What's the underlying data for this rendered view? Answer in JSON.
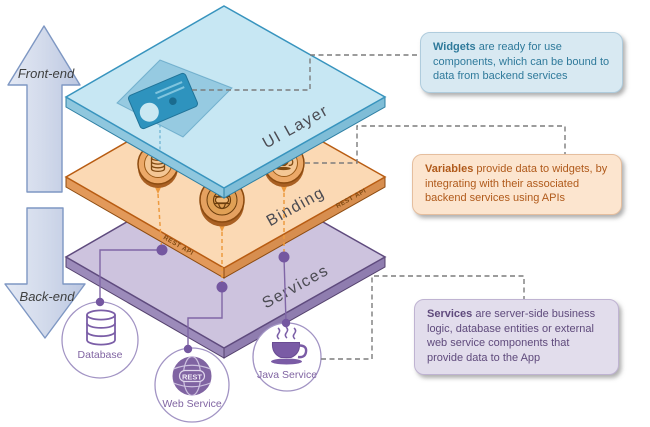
{
  "arrows": {
    "front_end_label": "Front-end",
    "back_end_label": "Back-end",
    "fill": "#D5DCEC",
    "border": "#7E97C3"
  },
  "layers": {
    "ui": {
      "label": "UI Layer",
      "fill": "#C7E7F3",
      "accent": "#3894BE",
      "widget_icon": "profile-card-icon"
    },
    "binding": {
      "label": "Binding",
      "edge_label": "REST API",
      "fill": "#FBD9B4",
      "accent": "#B85C12",
      "coin_icons": [
        "database-icon",
        "rest-globe-icon",
        "coffee-cup-icon"
      ]
    },
    "services": {
      "label": "Services",
      "fill": "#CDC3DE",
      "accent": "#5F4B7E"
    }
  },
  "backend_services": [
    {
      "label": "Database",
      "icon": "database-cylinder-icon"
    },
    {
      "label": "Web Service",
      "icon": "rest-globe-icon",
      "badge": "REST"
    },
    {
      "label": "Java Service",
      "icon": "coffee-cup-icon"
    }
  ],
  "notes": [
    {
      "lead": "Widgets",
      "text": "are ready for use components, which can be bound to data from backend services",
      "bg": "#D8E9F2",
      "fg": "#2F7A9B"
    },
    {
      "lead": "Variables",
      "text": "provide data to widgets, by integrating with their associated backend services using APIs",
      "bg": "#FCE5CF",
      "fg": "#B05A1B"
    },
    {
      "lead": "Services",
      "text": "are server-side business logic, database entities or external web service components that provide data to the App",
      "bg": "#E2DDEC",
      "fg": "#5F4A7C"
    }
  ],
  "connectors": {
    "dashed_color": "#7C7C7C",
    "orange_dash": "#ED9A3F",
    "purple_line": "#8066A6",
    "dot_color": "#7457A0"
  }
}
